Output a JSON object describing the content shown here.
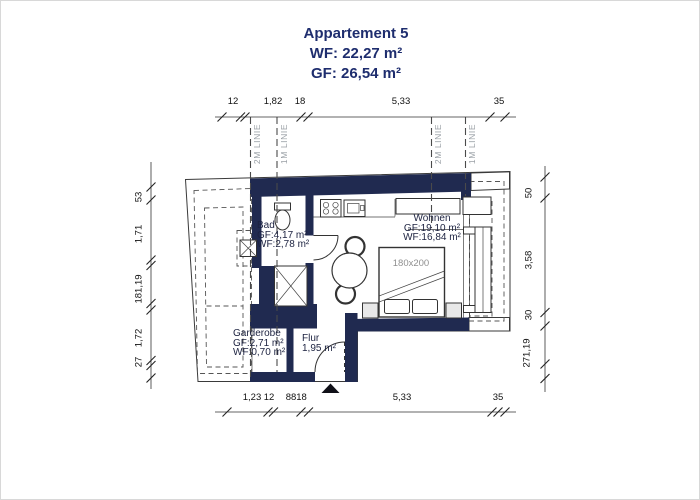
{
  "title": {
    "name": "Appartement 5",
    "wf": "WF: 22,27 m²",
    "gf": "GF: 26,54 m²"
  },
  "rooms": {
    "bad": {
      "name": "Bad",
      "gf": "GF:4,17 m²",
      "wf": "WF:2,78 m²"
    },
    "wohnen": {
      "name": "Wohnen",
      "gf": "GF:19,10 m²",
      "wf": "WF:16,84 m²"
    },
    "garderobe": {
      "name": "Garderobe",
      "gf": "GF:2,71 m²",
      "wf": "WF:0,70 m²"
    },
    "flur": {
      "name": "Flur",
      "area": "1,95 m²"
    }
  },
  "furniture": {
    "bed_size": "180x200"
  },
  "height_lines": [
    "2M LINIE",
    "1M LINIE",
    "2M LINIE",
    "1M LINIE"
  ],
  "dimensions": {
    "top": [
      "12",
      "1,82",
      "18",
      "5,33",
      "35"
    ],
    "bottom": [
      "1,23",
      "12",
      "88",
      "18",
      "5,33",
      "35"
    ],
    "left": [
      "53",
      "1,71",
      "181,19",
      "1,72",
      "27"
    ],
    "right": [
      "50",
      "3,58",
      "30",
      "271,19"
    ]
  },
  "colors": {
    "wall": "#202a50",
    "title_text": "#1e2d6e",
    "label_text": "#1c2240",
    "muted_text": "#8f8f8f",
    "height_line_text": "#9aa0a6"
  }
}
